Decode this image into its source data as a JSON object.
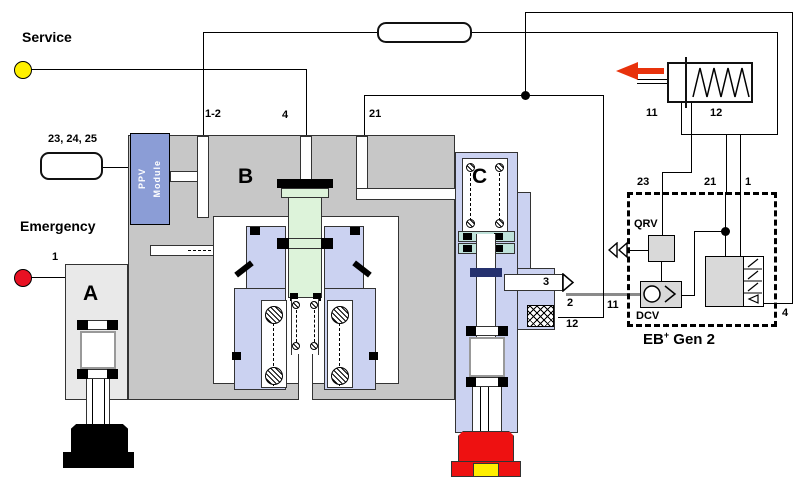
{
  "colors": {
    "body_gray": "#c7c7c7",
    "valve_a_gray": "#e9e9e9",
    "lavender": "#cbd2f1",
    "piston_green": "#ddf3da",
    "seat_teal": "#bfe2da",
    "ppv_blue": "#8b9dd6",
    "navy_seal": "#25316e",
    "cap_red": "#ee1111",
    "cap_yellow": "#ffee00",
    "arrow_red": "#e8320c",
    "service_yellow": "#fff000",
    "emergency_red": "#e81123",
    "pipe_gray": "#8a8a8a"
  },
  "labels": {
    "service": "Service",
    "emergency": "Emergency",
    "emergency_port": "1",
    "inlet_box": "23, 24, 25",
    "valve_port_12": "1-2",
    "valve_port_4": "4",
    "valve_port_21": "21",
    "section_a": "A",
    "section_b": "B",
    "section_c": "C",
    "ppv_line1": "PPV",
    "ppv_line2": "Module",
    "port_3": "3",
    "port_2": "2",
    "port_12": "12",
    "actuator_11": "11",
    "actuator_12": "12",
    "eb_23": "23",
    "eb_21": "21",
    "eb_1": "1",
    "eb_4": "4",
    "eb_11": "11",
    "qrv": "QRV",
    "dcv": "DCV",
    "eb_title_eb": "EB",
    "eb_title_sup": "+",
    "eb_title_rest": " Gen 2"
  }
}
